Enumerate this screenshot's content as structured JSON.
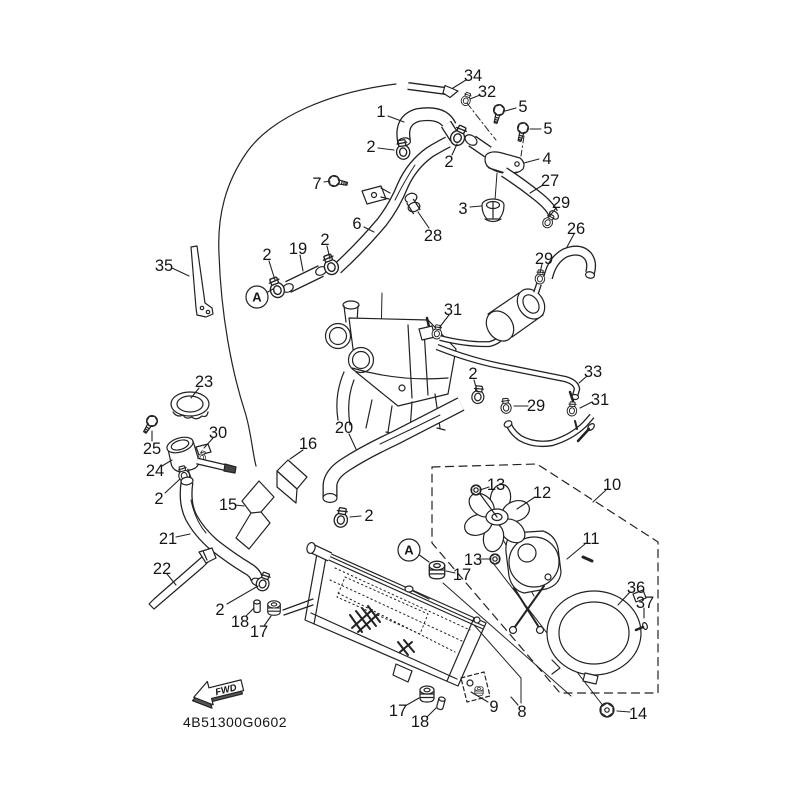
{
  "diagram": {
    "footer_code": "4B51300G0602",
    "fwd_label": "FWD",
    "colors": {
      "line_color": "#222222",
      "background": "#ffffff"
    },
    "part_labels": [
      {
        "text": "1",
        "x": 381,
        "y": 111,
        "leader": [
          388,
          116,
          404,
          122
        ]
      },
      {
        "text": "2",
        "x": 371,
        "y": 146,
        "leader": [
          378,
          148,
          394,
          150
        ]
      },
      {
        "text": "34",
        "x": 473,
        "y": 75,
        "leader": [
          466,
          80,
          453,
          88
        ]
      },
      {
        "text": "32",
        "x": 487,
        "y": 91,
        "leader": [
          480,
          95,
          470,
          99
        ]
      },
      {
        "text": "5",
        "x": 523,
        "y": 106,
        "leader": [
          516,
          108,
          505,
          111
        ]
      },
      {
        "text": "5",
        "x": 548,
        "y": 128,
        "leader": [
          541,
          129,
          530,
          129
        ]
      },
      {
        "text": "4",
        "x": 547,
        "y": 158,
        "leader": [
          539,
          159,
          524,
          163
        ]
      },
      {
        "text": "27",
        "x": 550,
        "y": 180,
        "leader": [
          543,
          185,
          530,
          193
        ]
      },
      {
        "text": "29",
        "x": 561,
        "y": 202,
        "leader": [
          556,
          208,
          549,
          217
        ]
      },
      {
        "text": "26",
        "x": 576,
        "y": 228,
        "leader": [
          574,
          234,
          567,
          247
        ]
      },
      {
        "text": "3",
        "x": 463,
        "y": 208,
        "leader": [
          470,
          207,
          481,
          206
        ]
      },
      {
        "text": "28",
        "x": 433,
        "y": 235,
        "leader": [
          429,
          228,
          418,
          212
        ]
      },
      {
        "text": "7",
        "x": 317,
        "y": 183,
        "leader": [
          324,
          182,
          330,
          181
        ]
      },
      {
        "text": "6",
        "x": 357,
        "y": 223,
        "leader": [
          364,
          227,
          374,
          232
        ]
      },
      {
        "text": "2",
        "x": 449,
        "y": 161,
        "leader": [
          452,
          155,
          457,
          144
        ]
      },
      {
        "text": "19",
        "x": 298,
        "y": 248,
        "leader": [
          300,
          255,
          303,
          271
        ]
      },
      {
        "text": "2",
        "x": 267,
        "y": 254,
        "leader": [
          269,
          261,
          275,
          280
        ]
      },
      {
        "text": "2",
        "x": 325,
        "y": 239,
        "leader": [
          327,
          246,
          330,
          259
        ]
      },
      {
        "text": "35",
        "x": 164,
        "y": 265,
        "leader": [
          172,
          268,
          189,
          276
        ]
      },
      {
        "text": "23",
        "x": 204,
        "y": 381,
        "leader": [
          199,
          388,
          191,
          398
        ]
      },
      {
        "text": "30",
        "x": 218,
        "y": 432,
        "leader": [
          213,
          438,
          204,
          448
        ]
      },
      {
        "text": "25",
        "x": 152,
        "y": 448,
        "leader": [
          152,
          441,
          152,
          431
        ]
      },
      {
        "text": "24",
        "x": 155,
        "y": 470,
        "leader": [
          162,
          466,
          172,
          460
        ]
      },
      {
        "text": "16",
        "x": 308,
        "y": 443,
        "leader": [
          303,
          450,
          290,
          459
        ]
      },
      {
        "text": "20",
        "x": 344,
        "y": 427,
        "leader": [
          349,
          434,
          356,
          449
        ]
      },
      {
        "text": "15",
        "x": 228,
        "y": 504,
        "leader": [
          235,
          505,
          244,
          506
        ]
      },
      {
        "text": "2",
        "x": 159,
        "y": 498,
        "leader": [
          165,
          493,
          180,
          479
        ]
      },
      {
        "text": "2",
        "x": 369,
        "y": 515,
        "leader": [
          361,
          516,
          350,
          517
        ]
      },
      {
        "text": "21",
        "x": 168,
        "y": 538,
        "leader": [
          176,
          537,
          190,
          534
        ]
      },
      {
        "text": "22",
        "x": 162,
        "y": 568,
        "leader": [
          167,
          574,
          176,
          585
        ]
      },
      {
        "text": "2",
        "x": 220,
        "y": 609,
        "leader": [
          227,
          604,
          258,
          586
        ]
      },
      {
        "text": "18",
        "x": 240,
        "y": 621,
        "leader": [
          246,
          616,
          254,
          608
        ]
      },
      {
        "text": "17",
        "x": 259,
        "y": 631,
        "leader": [
          264,
          626,
          271,
          616
        ]
      },
      {
        "text": "31",
        "x": 453,
        "y": 309,
        "leader": [
          449,
          315,
          439,
          328
        ]
      },
      {
        "text": "2",
        "x": 473,
        "y": 373,
        "leader": [
          474,
          380,
          477,
          391
        ]
      },
      {
        "text": "29",
        "x": 544,
        "y": 258,
        "leader": [
          542,
          264,
          540,
          273
        ]
      },
      {
        "text": "33",
        "x": 593,
        "y": 371,
        "leader": [
          587,
          376,
          579,
          383
        ]
      },
      {
        "text": "29",
        "x": 536,
        "y": 405,
        "leader": [
          528,
          406,
          514,
          406
        ]
      },
      {
        "text": "31",
        "x": 600,
        "y": 399,
        "leader": [
          592,
          402,
          580,
          408
        ]
      },
      {
        "text": "13",
        "x": 496,
        "y": 484,
        "leader": [
          489,
          487,
          480,
          490
        ]
      },
      {
        "text": "12",
        "x": 542,
        "y": 492,
        "leader": [
          535,
          497,
          517,
          509
        ]
      },
      {
        "text": "10",
        "x": 612,
        "y": 484,
        "leader": [
          606,
          490,
          593,
          502
        ]
      },
      {
        "text": "11",
        "x": 591,
        "y": 538,
        "leader": [
          585,
          544,
          567,
          559
        ]
      },
      {
        "text": "13",
        "x": 473,
        "y": 559,
        "leader": [
          480,
          559,
          490,
          559
        ]
      },
      {
        "text": "17",
        "x": 462,
        "y": 574,
        "leader": [
          455,
          573,
          446,
          571
        ]
      },
      {
        "text": "36",
        "x": 636,
        "y": 587,
        "leader": [
          630,
          592,
          618,
          605
        ]
      },
      {
        "text": "37",
        "x": 645,
        "y": 602,
        "leader": [
          644,
          608,
          644,
          618
        ]
      },
      {
        "text": "14",
        "x": 638,
        "y": 713,
        "leader": [
          630,
          712,
          617,
          711
        ]
      },
      {
        "text": "17",
        "x": 398,
        "y": 710,
        "leader": [
          405,
          706,
          419,
          698
        ]
      },
      {
        "text": "18",
        "x": 420,
        "y": 721,
        "leader": [
          427,
          717,
          436,
          708
        ]
      },
      {
        "text": "9",
        "x": 494,
        "y": 706,
        "leader": [
          488,
          702,
          471,
          692
        ]
      },
      {
        "text": "8",
        "x": 522,
        "y": 711,
        "leader": [
          518,
          705,
          511,
          697
        ]
      }
    ],
    "ref_markers": [
      {
        "text": "A",
        "x": 257,
        "y": 297,
        "r": 11,
        "leader": [
          266,
          293,
          273,
          289
        ]
      },
      {
        "text": "A",
        "x": 409,
        "y": 550,
        "r": 11,
        "leader": [
          418,
          554,
          429,
          562
        ]
      }
    ]
  }
}
